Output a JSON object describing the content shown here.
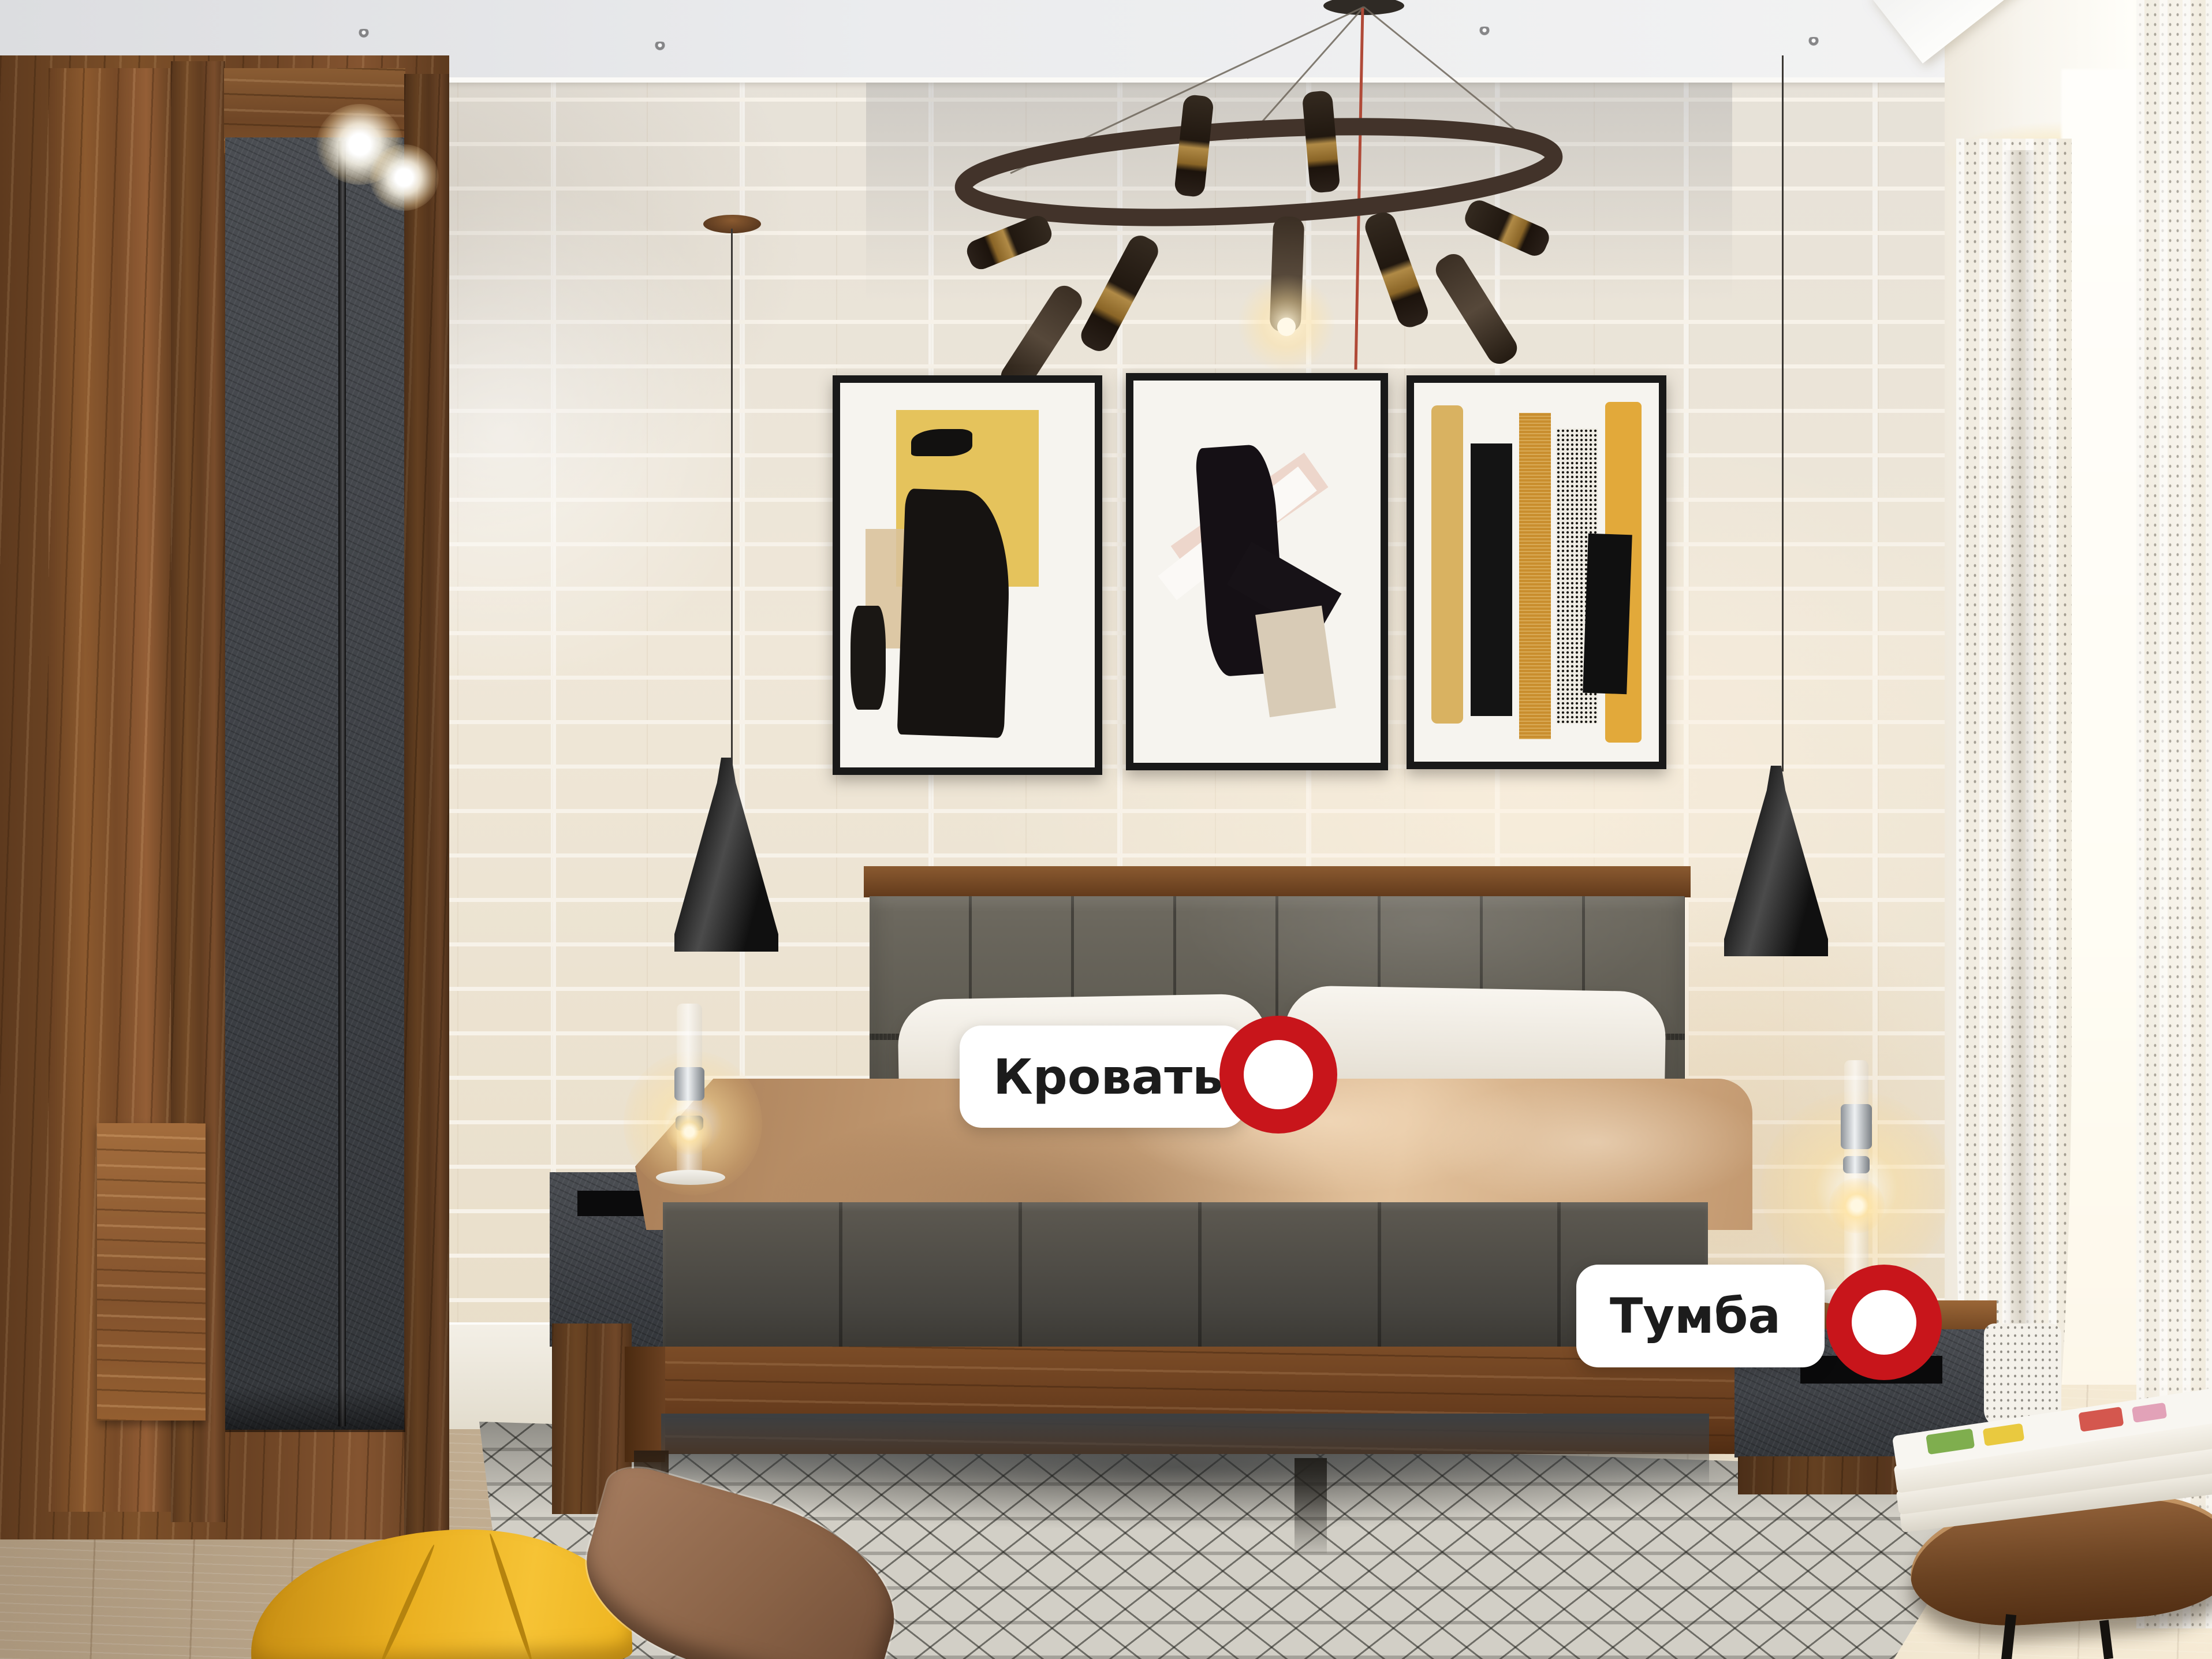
{
  "hotspots": [
    {
      "id": "bed",
      "label": "Кровать",
      "marker": "red-ring"
    },
    {
      "id": "nightstand",
      "label": "Тумба",
      "marker": "red-ring"
    }
  ],
  "theme": {
    "marker_red": "#C8151B",
    "label_bg": "#FFFFFF",
    "label_text": "#1C1C1C"
  }
}
